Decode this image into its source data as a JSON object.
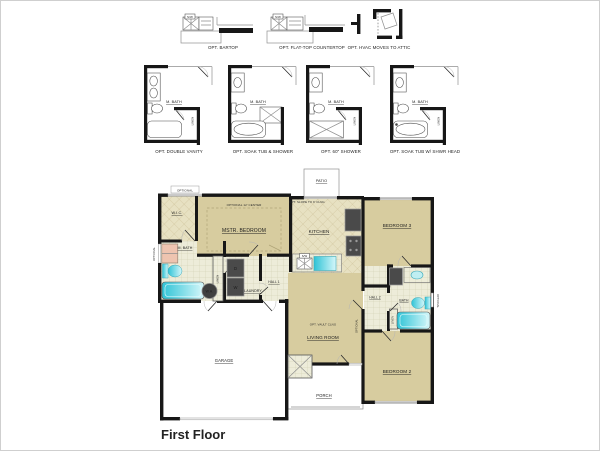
{
  "title": "First Floor",
  "options_row1": [
    {
      "label": "OPT. BARTOP",
      "sink": "S/W"
    },
    {
      "label": "OPT. FLAT-TOP COUNTERTOP",
      "sink": "S/W"
    },
    {
      "label": "OPT. HVAC MOVES TO ATTIC"
    }
  ],
  "options_row2": [
    {
      "label": "OPT. DOUBLE VANITY",
      "room": "M. BATH",
      "closet": "LINEN"
    },
    {
      "label": "OPT. SOAK TUB & SHOWER",
      "room": "M. BATH"
    },
    {
      "label": "OPT. 60\" SHOWER",
      "room": "M. BATH",
      "closet": "LINEN"
    },
    {
      "label": "OPT. SOAK TUB W/ SHWR HEAD",
      "room": "M. BATH",
      "closet": "LINEN"
    }
  ],
  "floorplan": {
    "patio": "PATIO",
    "optional": "OPTIONAL",
    "wic": "W.I.C.",
    "mbath": "M. BATH",
    "master_bedroom": "MSTR. BEDROOM",
    "master_note": "OPTIONAL 12' CENTER",
    "kitchen": "KITCHEN",
    "kitchen_note": "OPT. SLOPE TO 9' CLNG",
    "bedroom3": "BEDROOM 3",
    "laundry": "LAUNDRY",
    "hall1": "HALL 1",
    "hall2": "HALL 2",
    "bath2": "BATH",
    "linen": "LINEN",
    "bedroom2": "BEDROOM 2",
    "living_room": "LIVING ROOM",
    "living_note": "OPT. VAULT CLNG",
    "garage": "GARAGE",
    "porch": "PORCH",
    "water_heater": "W.H.",
    "washer": "W",
    "dryer": "D",
    "sink": "S/W"
  },
  "colors": {
    "wall": "#171717",
    "carpet": "#d7cc9f",
    "tile": "#edecd9",
    "fixture_teal": "#3fc9da",
    "shower_pink": "#eec4b0",
    "appliance": "#4a4a4a"
  }
}
